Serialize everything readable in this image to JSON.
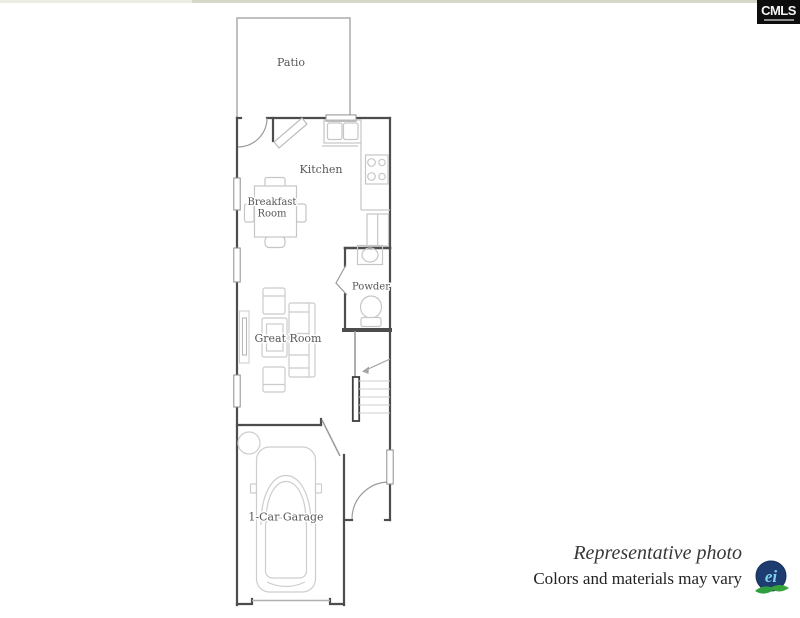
{
  "branding": {
    "mls_logo_text": "CMLS"
  },
  "floorplan": {
    "rooms": {
      "patio": "Patio",
      "kitchen": "Kitchen",
      "breakfast_line1": "Breakfast",
      "breakfast_line2": "Room",
      "powder": "Powder",
      "great_room": "Great Room",
      "garage": "1-Car Garage"
    }
  },
  "caption": {
    "line1": "Representative photo",
    "line2": "Colors and materials may vary"
  },
  "ei_logo": {
    "text": "ei"
  },
  "colors": {
    "wall": "#4d4d4d",
    "fixture": "#c6c6c6",
    "door": "#9a9a9a",
    "label": "#575757",
    "badge_bg": "#0d0d0d",
    "ei_blue": "#1d3d70",
    "ei_light_blue": "#7fd0ee",
    "ei_green": "#2e9e3e",
    "topbar": "#d4d8c7"
  }
}
